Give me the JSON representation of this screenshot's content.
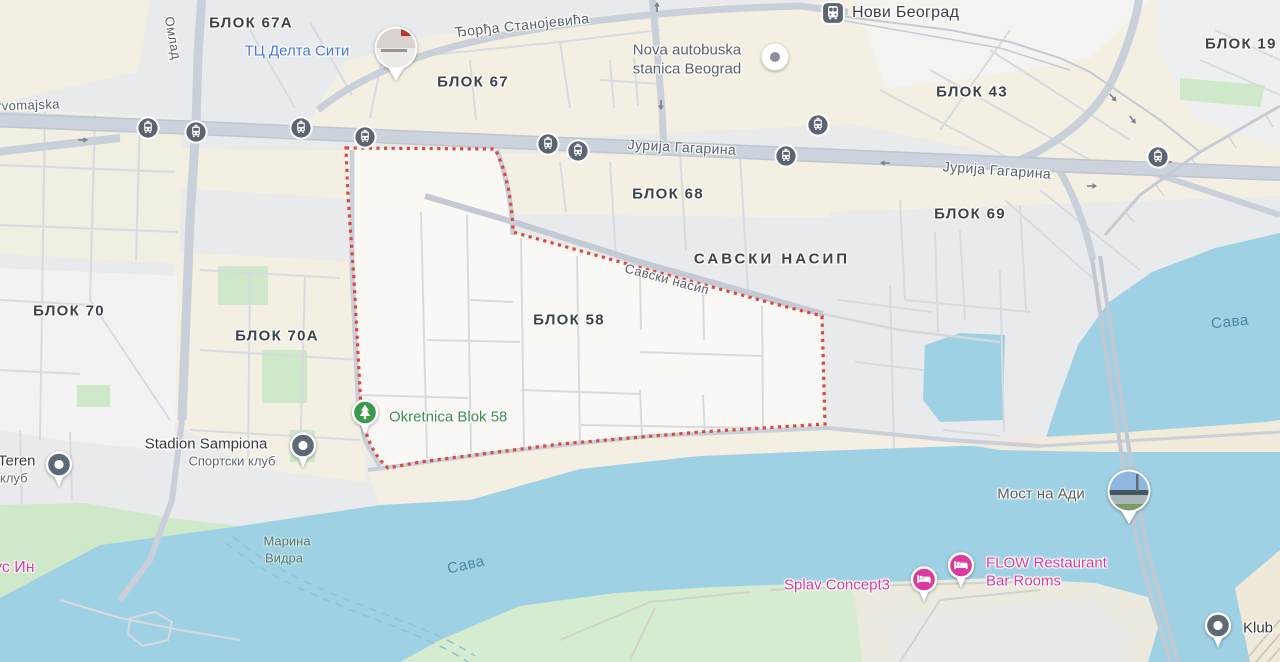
{
  "map": {
    "type": "city-map-belgrade-blok58",
    "highlighted_region": "БЛОК 58",
    "colors": {
      "water": "#9fd1e5",
      "land": "#e9eaec",
      "land_white": "#f2f2f3",
      "beige": "#f3efe2",
      "green": "#cfe8ca",
      "road": "#c9d0d9",
      "road_minor": "#d7dbdf",
      "boundary_red": "#e0483b",
      "highlight_fill": "#fbf9f4",
      "poi_pink": "#dc3a9e",
      "poi_blue": "#4a77dd",
      "poi_green": "#3d8d4d",
      "water_label": "#4a87a6",
      "marker_slate": "#5b6470",
      "marker_gray": "#5d6a76"
    },
    "icons": {
      "tram_stop": "tram-stop-icon",
      "train_station": "train-station-icon",
      "transit_hub": "transit-hub-dot-icon",
      "poi_pin": "pin-dot-icon",
      "park_pin": "pin-tree-icon",
      "lodging_pin": "pin-bed-icon",
      "photo_marker": "photo-circle-icon",
      "one_way_arrow": "one-way-arrow-icon"
    },
    "labels": {
      "blok67a": "БЛОК 67А",
      "delta_city": "ТЦ Делта Сити",
      "djordja_stanojevica": "Ђорђа Станојевића",
      "blok67": "БЛОК 67",
      "nova_autobuska_line1": "Nova autobuska",
      "nova_autobuska_line2": "stanica Beograd",
      "novi_beograd": "Нови Београд",
      "blok43": "БЛОК 43",
      "blok19": "БЛОК 19",
      "jurija_gagarina_west": "Јурија Гагарина",
      "jurija_gagarina_east": "Јурија Гагарина",
      "blok68": "БЛОК 68",
      "blok69": "БЛОК 69",
      "savski_nasip_area": "САВСКИ НАСИП",
      "savski_nasip_street": "Савски насип",
      "blok58": "БЛОК 58",
      "blok70": "БЛОК 70",
      "blok70a": "БЛОК 70А",
      "okretnica": "Okretnica Blok 58",
      "stadion": "Stadion Sampiona",
      "sportski_klub": "Спортски клуб",
      "teren": "Teren",
      "klub_left": "клуб",
      "omladinskih": "Омлад",
      "prvomajska": "rvomajska",
      "marina_vidra_line1": "Марина",
      "marina_vidra_line2": "Видра",
      "sava_main": "Сава",
      "sava_east": "Сава",
      "us_in": "ус Ин",
      "splav_concept3": "Splav Concept3",
      "flow_line1": "FLOW Restaurant",
      "flow_line2": "Bar Rooms",
      "most_na_adi": "Мост на Ади",
      "klub_right": "Klub"
    }
  }
}
